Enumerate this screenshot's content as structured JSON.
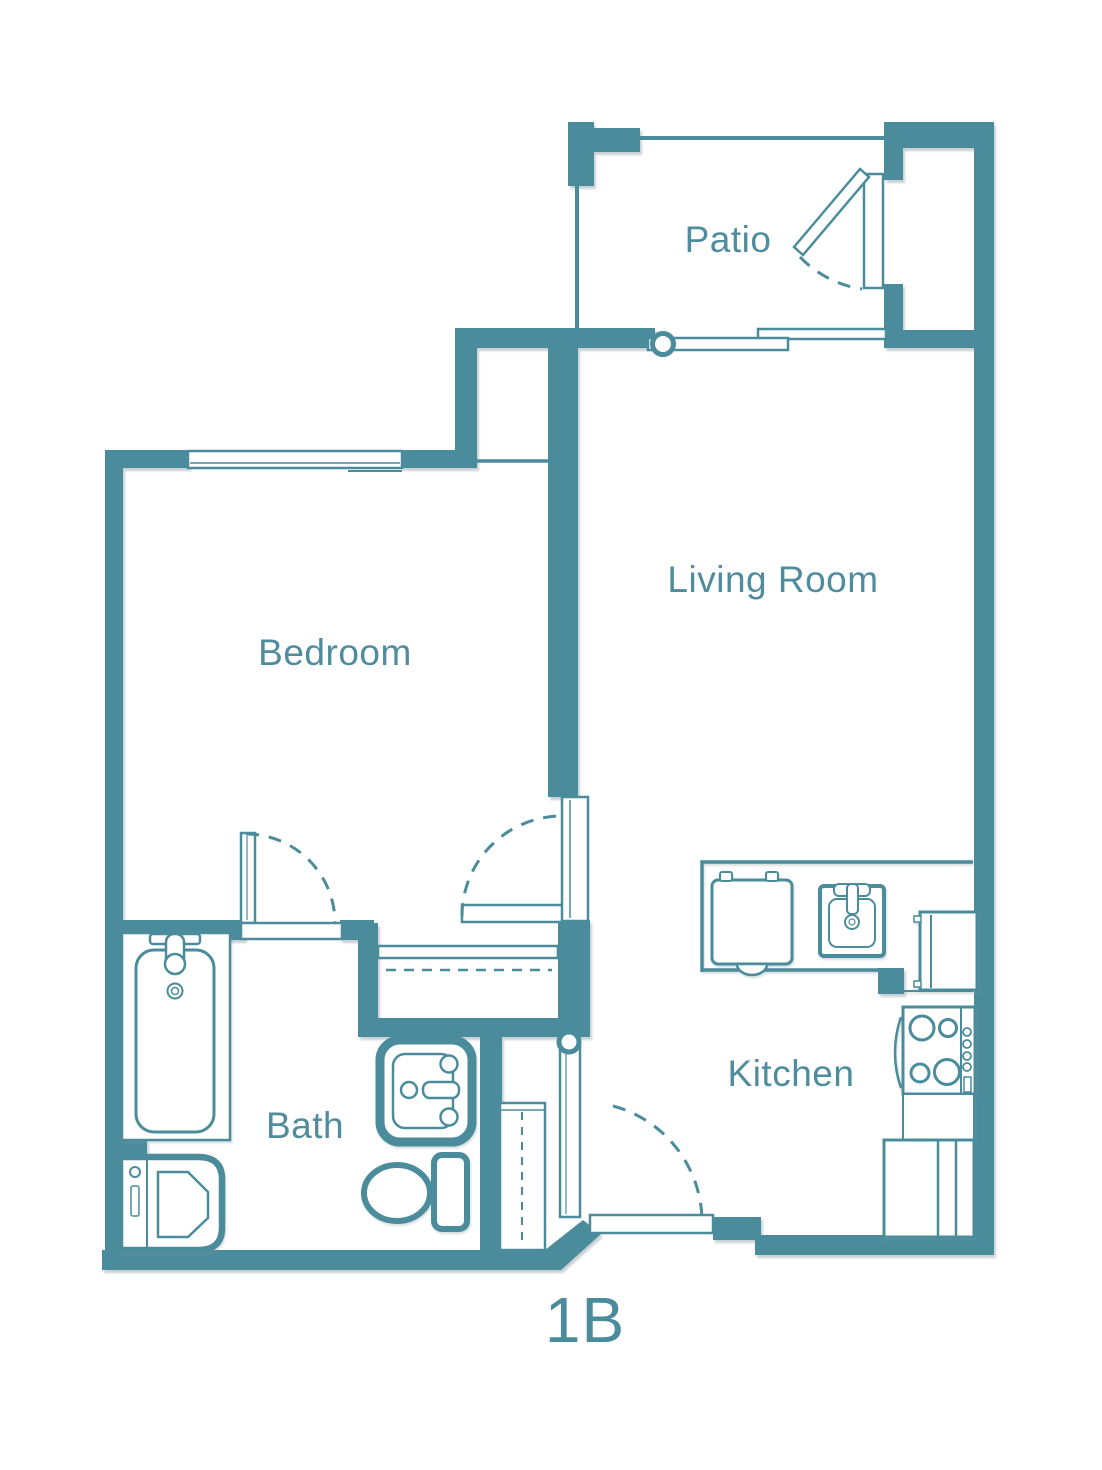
{
  "title": {
    "label": "1B"
  },
  "rooms": [
    {
      "name": "patio",
      "label": "Patio"
    },
    {
      "name": "living-room",
      "label": "Living Room"
    },
    {
      "name": "bedroom",
      "label": "Bedroom"
    },
    {
      "name": "bath",
      "label": "Bath"
    },
    {
      "name": "kitchen",
      "label": "Kitchen"
    }
  ],
  "fixtures": [
    "bathtub",
    "washer-dryer",
    "bathroom-sink-vanity",
    "toilet",
    "dishwasher",
    "kitchen-sink",
    "refrigerator",
    "stove-cooktop",
    "base-cabinet",
    "coat-closet",
    "hall-closet",
    "patio-swing-door",
    "sliding-glass-door",
    "bedroom-window",
    "entry-door",
    "bedroom-door",
    "bathroom-door"
  ],
  "colors": {
    "wall": "#4a8c9c",
    "label": "#4e8c9e",
    "background": "#ffffff"
  }
}
